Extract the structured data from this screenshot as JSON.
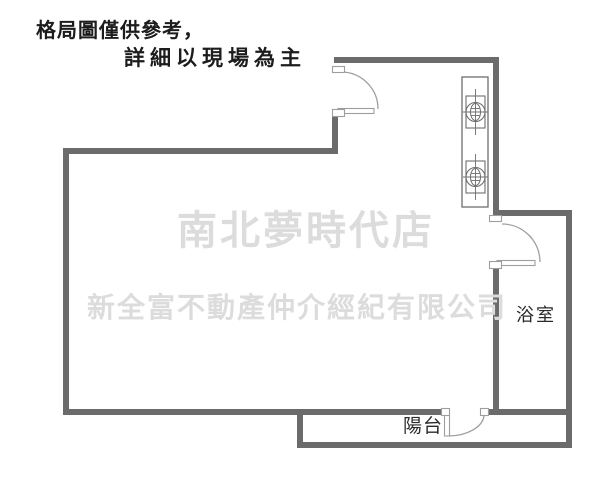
{
  "disclaimer": {
    "line1": "格局圖僅供參考，",
    "line2": "詳細以現場為主"
  },
  "watermarks": {
    "store_name": "南北夢時代店",
    "company_name": "新全富不動產仲介經紀有限公司"
  },
  "room_labels": {
    "bathroom": "浴室",
    "balcony": "陽台"
  },
  "fixtures": {
    "stove": "gas-stove-2-burner-icon",
    "doors": [
      "entrance-door-icon",
      "bathroom-door-icon",
      "balcony-door-icon"
    ]
  },
  "colors": {
    "wall": "#6b6b6b",
    "door": "#9e9e9e",
    "fixture": "#6e6e6e",
    "disclaimer_text": "#1c1c1c",
    "room_label_text": "#2b2b2b",
    "watermark": "#dcdcdc",
    "background": "#ffffff"
  }
}
